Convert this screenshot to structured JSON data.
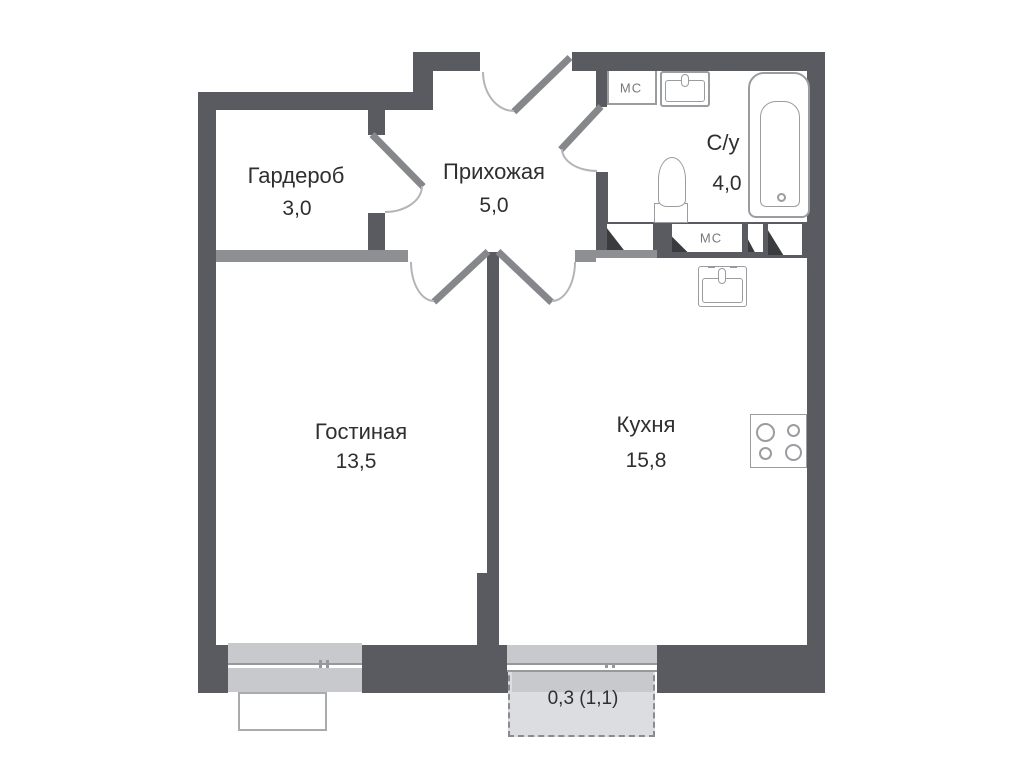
{
  "rooms": {
    "wardrobe": {
      "name": "Гардероб",
      "area": "3,0"
    },
    "hallway": {
      "name": "Прихожая",
      "area": "5,0"
    },
    "bathroom": {
      "name": "С/у",
      "area": "4,0"
    },
    "living_room": {
      "name": "Гостиная",
      "area": "13,5"
    },
    "kitchen": {
      "name": "Кухня",
      "area": "15,8"
    },
    "balcony": {
      "area": "0,3 (1,1)"
    }
  },
  "shafts": {
    "cabinet_label": "МС",
    "duct_label": "МС"
  },
  "colors": {
    "wall_dark": "#595b60",
    "wall_light": "#8d8f92",
    "sill": "#c8c9cc",
    "balcony_fill": "#dcdde0",
    "fixture_outline": "#9b9c9f",
    "text": "#2f2f31",
    "muted_text": "#77787b"
  }
}
